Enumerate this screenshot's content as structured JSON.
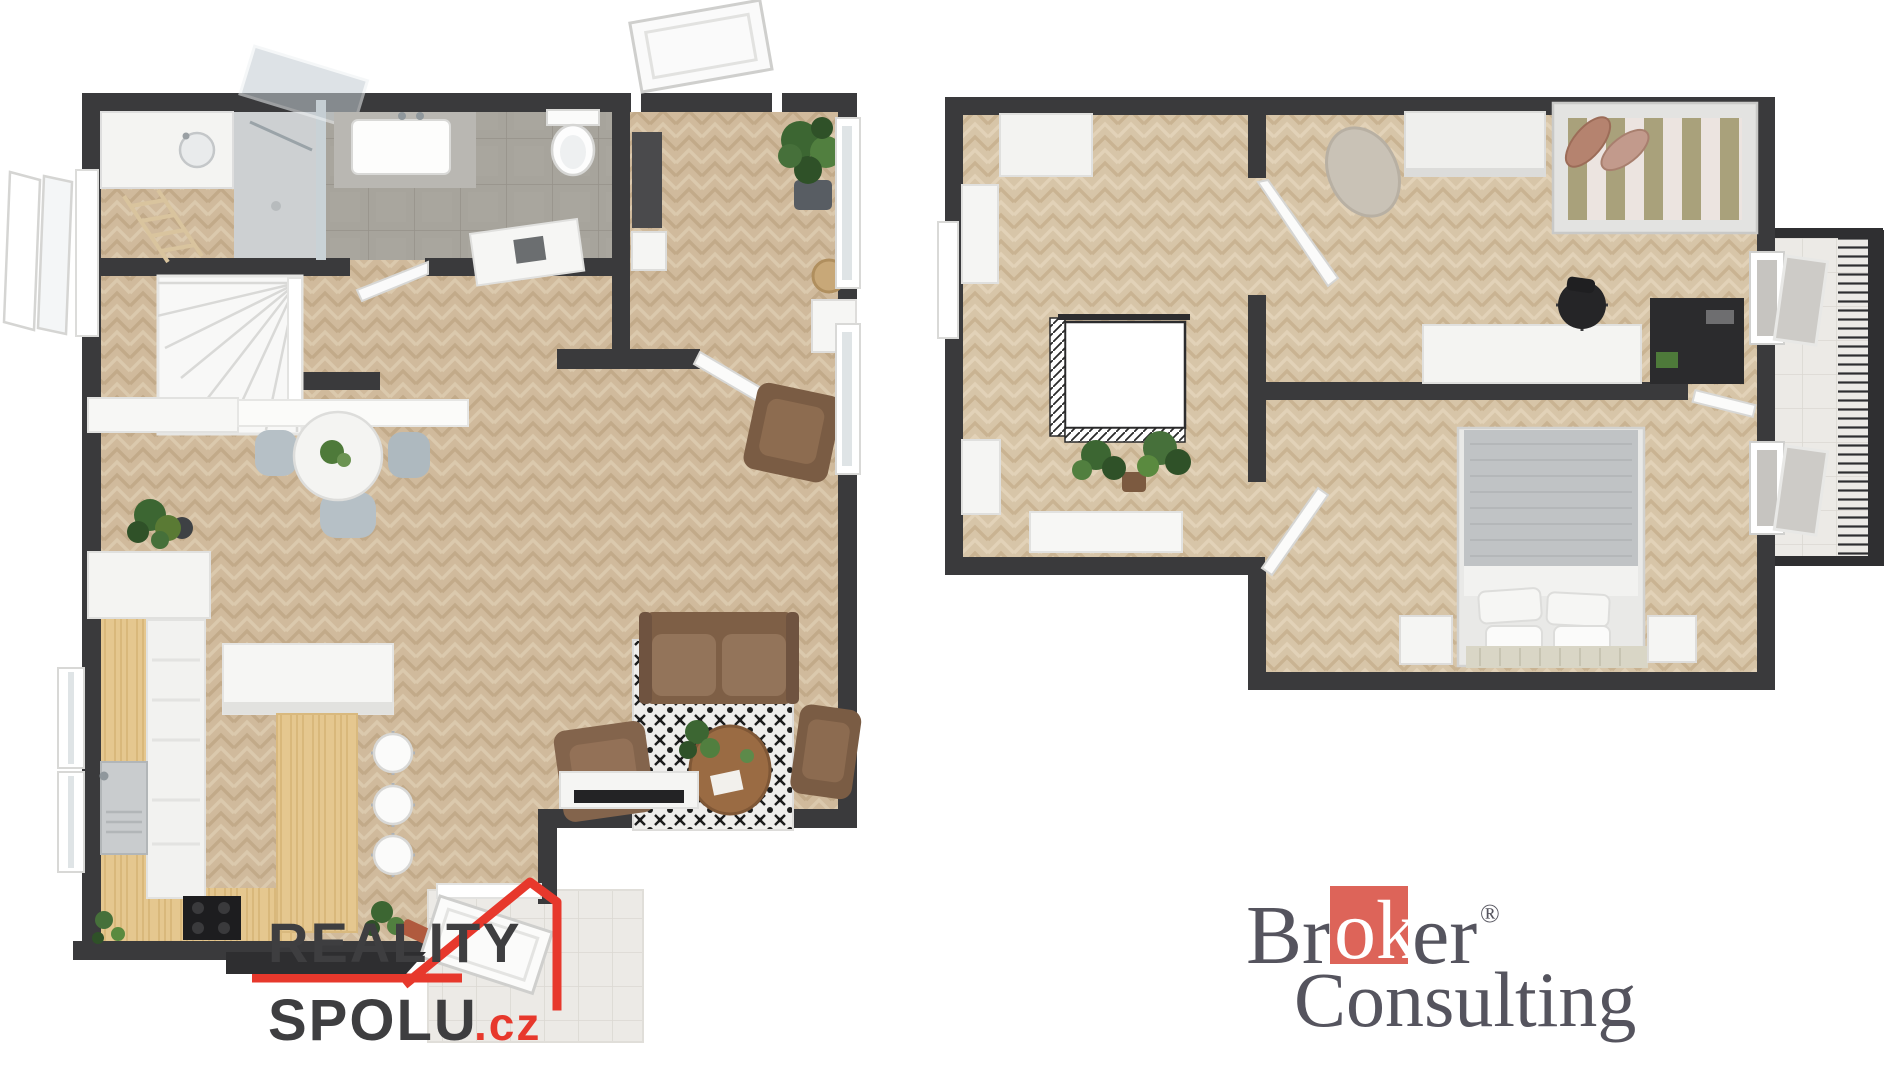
{
  "page": {
    "background": "#ffffff",
    "description": "3D rendered two-storey apartment floor plan with agency watermarks"
  },
  "branding": {
    "reality_spolu": {
      "word_top": "REALITY",
      "word_bottom": "SPOLU",
      "tld": ".cz",
      "accent_color": "#e7382c",
      "text_color": "#3e3e40",
      "bar_color": "#2e2e30"
    },
    "broker_consulting": {
      "word1_prefix": "Br",
      "word1_highlight": "ok",
      "word1_suffix": "er",
      "registered_mark": "®",
      "word2": "Consulting",
      "square_color": "#dd6459",
      "text_color": "#55545e",
      "highlight_text_color": "#ffffff"
    }
  },
  "floor_plan_colors": {
    "wall": "#3a3a3c",
    "floor_left_plan": "#d1bc9e",
    "floor_right_plan": "#d7c5a8",
    "kitchen_wood": "#e5c78f",
    "bathroom_tile": "#a7a49c",
    "terrace_tile": "#eceae6",
    "glass": "#c3ccd2",
    "sofa_brown": "#8a6a4e",
    "rug_dark": "#1c1c1c",
    "plant_green": "#46703a",
    "bed_gray": "#c0c3c5",
    "bed_stripe_olive": "#a9a17b",
    "bed_stripe_cream": "#ece4e0"
  },
  "plans": {
    "left": {
      "id": "ground-floor",
      "rooms": [
        {
          "name": "laundry",
          "items": [
            "cabinet-with-sink",
            "drying-ladder",
            "walk-in-shower"
          ]
        },
        {
          "name": "bathroom",
          "items": [
            "vanity-sink",
            "toilet",
            "concrete-tile-floor",
            "door"
          ]
        },
        {
          "name": "entry-hall",
          "items": [
            "front-door-open",
            "dark-wardrobe",
            "bench",
            "potted-plant",
            "console-with-basin",
            "rattan-stool"
          ]
        },
        {
          "name": "stair-hall",
          "items": [
            "winder-staircase",
            "wall-shelf",
            "sideboard"
          ]
        },
        {
          "name": "dining-area",
          "items": [
            "round-table",
            "table-plant",
            "chairs",
            "monstera-plant"
          ]
        },
        {
          "name": "kitchen",
          "items": [
            "tall-cabinets",
            "counter-sink",
            "cooktop",
            "island-breakfast-bar",
            "bar-stools",
            "small-plants",
            "windows"
          ]
        },
        {
          "name": "living-room",
          "items": [
            "sofa",
            "armchair-left",
            "armchair-right",
            "armchair-top",
            "coffee-table",
            "patterned-rug",
            "tv-bench",
            "tv",
            "side-cabinet",
            "plant",
            "terrace-door",
            "terrace"
          ]
        }
      ]
    },
    "right": {
      "id": "upper-floor",
      "rooms": [
        {
          "name": "landing-bedroom",
          "items": [
            "wardrobe-top",
            "tall-cabinet",
            "low-cabinet",
            "sideboard",
            "stair-void-with-railing",
            "plants",
            "window"
          ]
        },
        {
          "name": "kids-room",
          "items": [
            "armchair",
            "wardrobe",
            "single-bed-striped",
            "desk",
            "office-chair",
            "dark-shelf",
            "door"
          ]
        },
        {
          "name": "master-bedroom",
          "items": [
            "double-bed",
            "pillows",
            "foot-bench",
            "nightstand-left",
            "nightstand-right",
            "door"
          ]
        },
        {
          "name": "balcony",
          "items": [
            "tiled-floor",
            "metal-railing",
            "tilted-windows"
          ]
        }
      ]
    }
  }
}
